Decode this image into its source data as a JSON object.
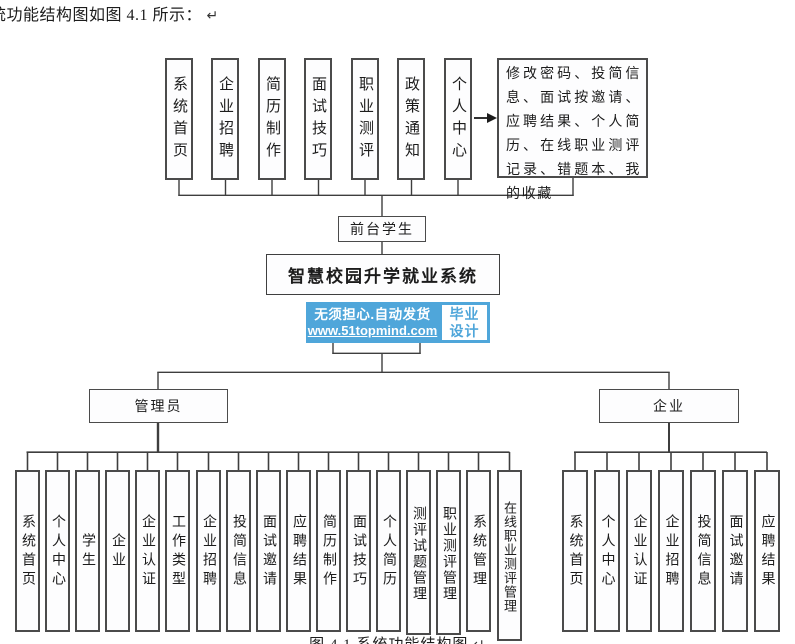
{
  "page": {
    "intro_text": "统功能结构图如图 4.1 所示：",
    "intro_return_mark": "↵",
    "caption_text": "图 4.1  系统功能结构图",
    "caption_return_mark": "↵"
  },
  "diagram": {
    "top_row": {
      "items": [
        "系统首页",
        "企业招聘",
        "简历制作",
        "面试技巧",
        "职业测评",
        "政策通知",
        "个人中心"
      ]
    },
    "personal_center_detail": "修改密码、投简信息、面试按邀请、应聘结果、个人简历、在线职业测评记录、错题本、我的收藏",
    "front_student_label": "前台学生",
    "system_title": "智慧校园升学就业系统",
    "admin": {
      "label": "管理员",
      "children": [
        "系统首页",
        "个人中心",
        "学生",
        "企业",
        "企业认证",
        "工作类型",
        "企业招聘",
        "投简信息",
        "面试邀请",
        "应聘结果",
        "简历制作",
        "面试技巧",
        "个人简历",
        "测评试题管理",
        "职业测评管理",
        "系统管理",
        "在线职业测评管理"
      ]
    },
    "enterprise": {
      "label": "企业",
      "children": [
        "系统首页",
        "个人中心",
        "企业认证",
        "企业招聘",
        "投简信息",
        "面试邀请",
        "应聘结果"
      ]
    }
  },
  "watermark": {
    "line1": "无须担心.自动发货",
    "line2": "www.51topmind.com",
    "badge_line1": "毕业",
    "badge_line2": "设计",
    "accent_color": "#4fa6da"
  },
  "colors": {
    "line": "#3e3e3e",
    "box_border": "#4b4b4b",
    "background": "#ffffff"
  }
}
